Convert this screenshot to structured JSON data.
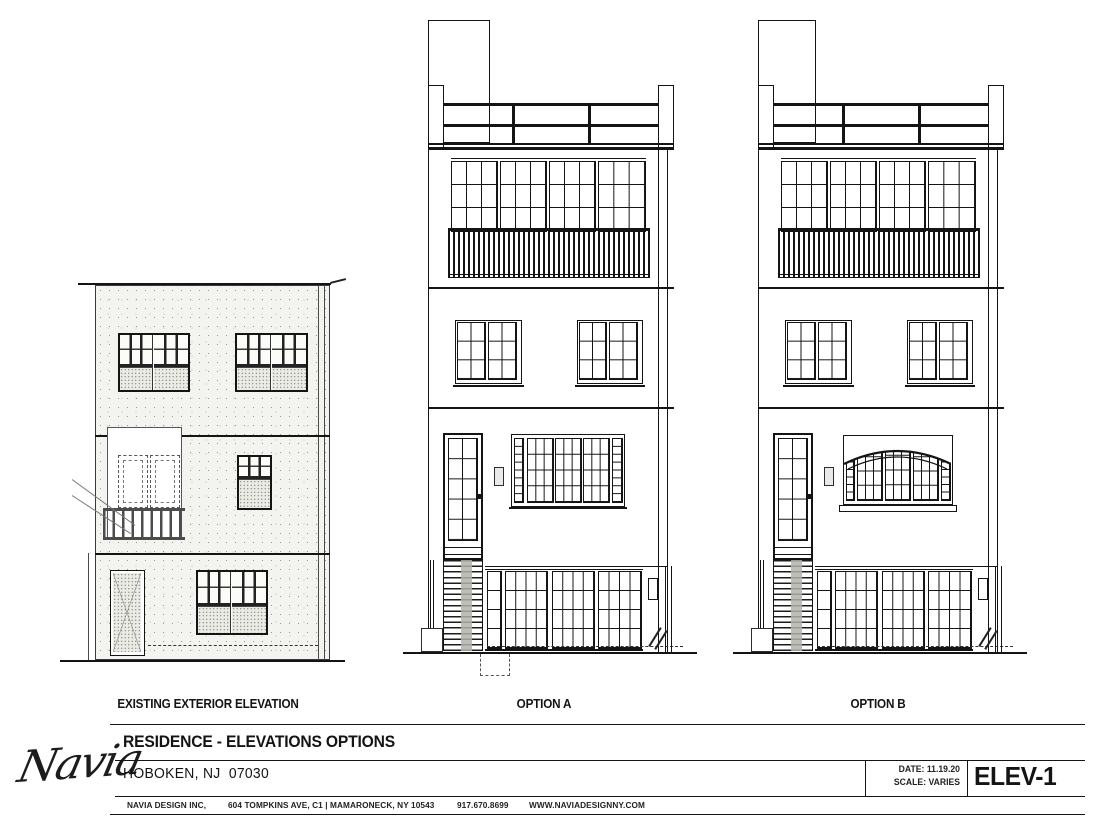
{
  "page": {
    "paper_color": "#ffffff",
    "line_color": "#141414",
    "masonry_tint": "#f3f3ef"
  },
  "drawings": {
    "existing": {
      "label": "EXISTING EXTERIOR ELEVATION"
    },
    "option_a": {
      "label": "OPTION A"
    },
    "option_b": {
      "label": "OPTION B"
    }
  },
  "title_block": {
    "logo_text": "Navia",
    "project_title": "RESIDENCE - ELEVATIONS OPTIONS",
    "location": "HOBOKEN, NJ  07030",
    "firm_name": "NAVIA DESIGN INC,",
    "address": "604 TOMPKINS AVE, C1 | MAMARONECK, NY 10543",
    "phone": "917.670.8699",
    "website": "WWW.NAVIADESIGNNY.COM",
    "date_label": "DATE: 11.19.20",
    "scale_label": "SCALE: VARIES",
    "sheet_number": "ELEV-1"
  }
}
